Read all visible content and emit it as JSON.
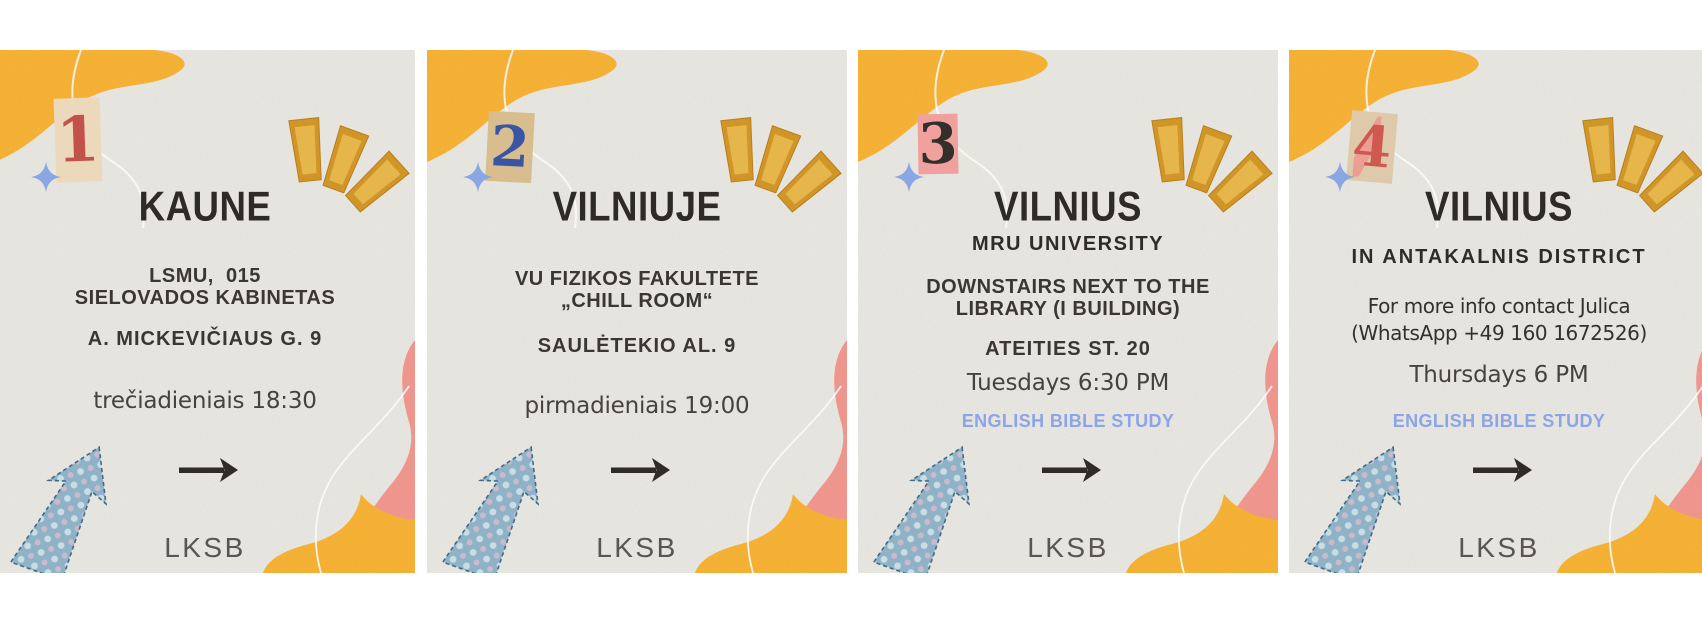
{
  "poster": {
    "panel_count": 4,
    "organization_logo": "LKSB"
  },
  "cards": [
    {
      "number": "1",
      "number_color": "#c4524c",
      "paper_color": "#ecd9bc",
      "title": "KAUNE",
      "location_line1": "LSMU,  015",
      "location_line2": "SIELOVADOS KABINETAS",
      "address": "A. MICKEVIČIAUS G. 9",
      "time": "trečiadieniais 18:30",
      "logo": "LKSB"
    },
    {
      "number": "2",
      "number_color": "#3a55a4",
      "paper_color": "#d8bd8e",
      "title": "VILNIUJE",
      "location_line1": "VU FIZIKOS FAKULTETE",
      "location_line2": "„CHILL ROOM“",
      "address": "SAULĖTEKIO AL. 9",
      "time": "pirmadieniais 19:00",
      "logo": "LKSB"
    },
    {
      "number": "3",
      "number_color": "#33302c",
      "paper_color": "#f0a19e",
      "title": "VILNIUS",
      "subtitle": "MRU UNIVERSITY",
      "location_line1": "DOWNSTAIRS NEXT TO THE",
      "location_line2": "LIBRARY (I BUILDING)",
      "address": "ATEITIES ST. 20",
      "time": "Tuesdays 6:30 PM",
      "english_label": "ENGLISH BIBLE STUDY",
      "logo": "LKSB"
    },
    {
      "number": "4",
      "number_color": "#cf5950",
      "paper_color": "#dfc9ab",
      "title": "VILNIUS",
      "subtitle": "IN ANTAKALNIS DISTRICT",
      "contact_line1": "For more info contact Julica",
      "contact_line2": "(WhatsApp +49 160 1672526)",
      "time": "Thursdays 6 PM",
      "english_label": "ENGLISH BIBLE STUDY",
      "logo": "LKSB"
    }
  ],
  "colors": {
    "page_background": "#ffffff",
    "card_background": "#e9e7e1",
    "coral_blob": "#f2938a",
    "yellow_blob": "#f8b02c",
    "gold_scrap": "#d2931d",
    "gold_scrap_light": "#e9b644",
    "sparkle": "#8aa6e3",
    "title_text": "#2e2b27",
    "body_text": "#3a3733",
    "time_text": "#45423f",
    "english_text": "#8ca4e8",
    "logo_text": "#595651",
    "fabric_arrow_blue": "#8fb2c7",
    "black_arrow": "#2e2b28"
  },
  "icons": {
    "sparkle": "sparkle-icon: four-point periwinkle star",
    "fabric_arrow": "fabric-arrow-icon: polka-dot fabric arrow pointing up-right",
    "right_arrow": "right-arrow-icon: black hand-drawn arrow pointing right",
    "paper_scraps": "paper-scraps-icon: three gold torn-paper rays"
  }
}
